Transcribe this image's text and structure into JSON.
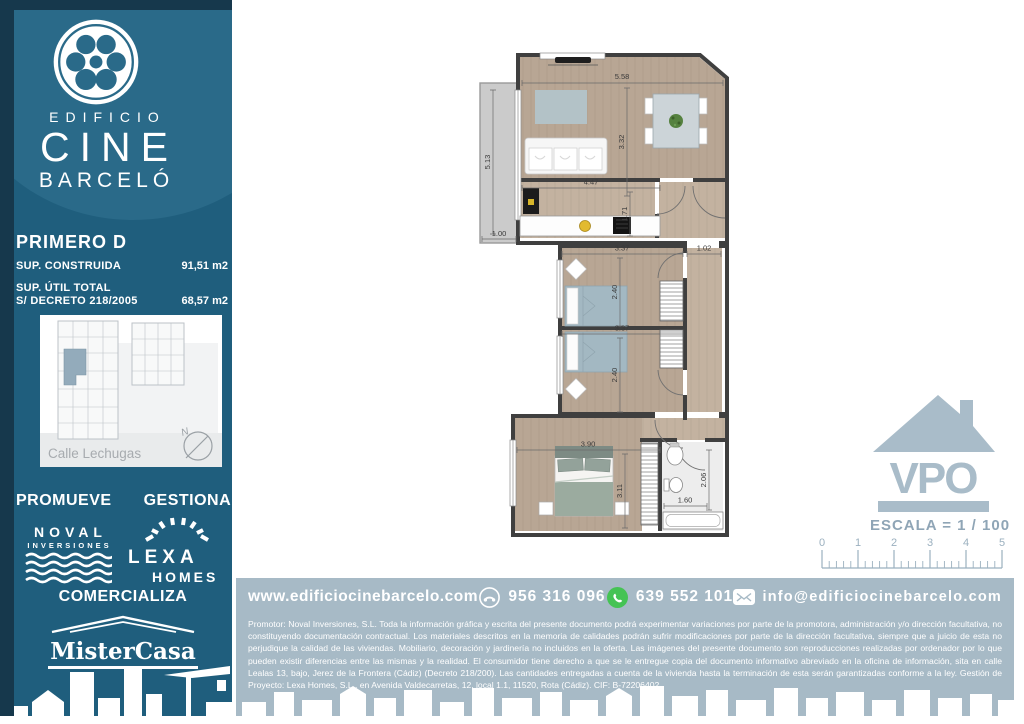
{
  "brand": {
    "building_word": "EDIFICIO",
    "name": "CINE",
    "surname": "BARCELÓ"
  },
  "unit": {
    "title": "PRIMERO D",
    "built_label": "SUP. CONSTRUIDA",
    "built_value": "91,51 m2",
    "useful_label_1": "SUP. ÚTIL TOTAL",
    "useful_label_2": "S/ DECRETO 218/2005",
    "useful_value": "68,57 m2"
  },
  "site_map": {
    "street": "Calle Lechugas",
    "compass": "N"
  },
  "companies": {
    "promueve_label": "PROMUEVE",
    "gestiona_label": "GESTIONA",
    "comercializa_label": "COMERCIALIZA",
    "noval_name": "NOVAL",
    "noval_sub": "INVERSIONES",
    "lexa_name": "LEXA",
    "lexa_sub": "HOMES",
    "mistercasa_name": "MisterCasa"
  },
  "contact": {
    "website": "www.edificiocinebarcelo.com",
    "phone": "956 316 096",
    "whatsapp": "639 552 101",
    "email": "info@edificiocinebarcelo.com"
  },
  "legal": "Promotor: Noval Inversiones, S.L. Toda la información gráfica y escrita del presente documento podrá experimentar variaciones por parte de la promotora, administración y/o dirección facultativa, no constituyendo documentación contractual. Los materiales descritos en la memoria de calidades podrán sufrir modificaciones por parte de la dirección facultativa, siempre que a juicio de esta no perjudique la calidad de las viviendas. Mobiliario, decoración y jardinería no incluidos en la oferta. Las imágenes del presente documento son reproducciones realizadas por ordenador por lo que pueden existir diferencias entre las mismas y la realidad. El consumidor tiene derecho a que se le entregue copia del documento informativo abreviado en la oficina de información, sita en calle Lealas 13, bajo, Jerez de la Frontera (Cádiz) (Decreto 218/200). Las cantidades entregadas a cuenta de la vivienda hasta la terminación de esta serán garantizadas conforme a la ley. Gestión de Proyecto: Lexa Homes, S.L., en Avenida Valdecarretas, 12, local 1.1, 11520, Rota (Cádiz). CIF: B-72206402.",
  "scale_block": {
    "vpo": "VPO",
    "escala_label": "ESCALA = 1 / 100",
    "ruler_ticks": [
      "0",
      "1",
      "2",
      "3",
      "4",
      "5"
    ]
  },
  "floorplan": {
    "dims": {
      "salon_width": "5.58",
      "salon_depth": "3.32",
      "terraza_height": "5.13",
      "terraza_width": "1.00",
      "cocina_width": "4.47",
      "cocina_depth": "1.71",
      "dorm1_width": "3.37",
      "dorm1_depth": "2.40",
      "pasillo_width": "1.02",
      "dorm2_width": "3.37",
      "dorm2_depth": "2.40",
      "dorm3_width": "3.90",
      "dorm3_depth": "3.11",
      "bano_depth": "2.06",
      "bano_width": "1.60"
    }
  },
  "colors": {
    "sidebar_teal": "#1f5e7d",
    "sidebar_teal_light": "#2a6a89",
    "sidebar_navy": "#16384c",
    "band_gray": "#a7bac6",
    "whatsapp_green": "#45c354",
    "highlight_unit": "#93abbb"
  }
}
